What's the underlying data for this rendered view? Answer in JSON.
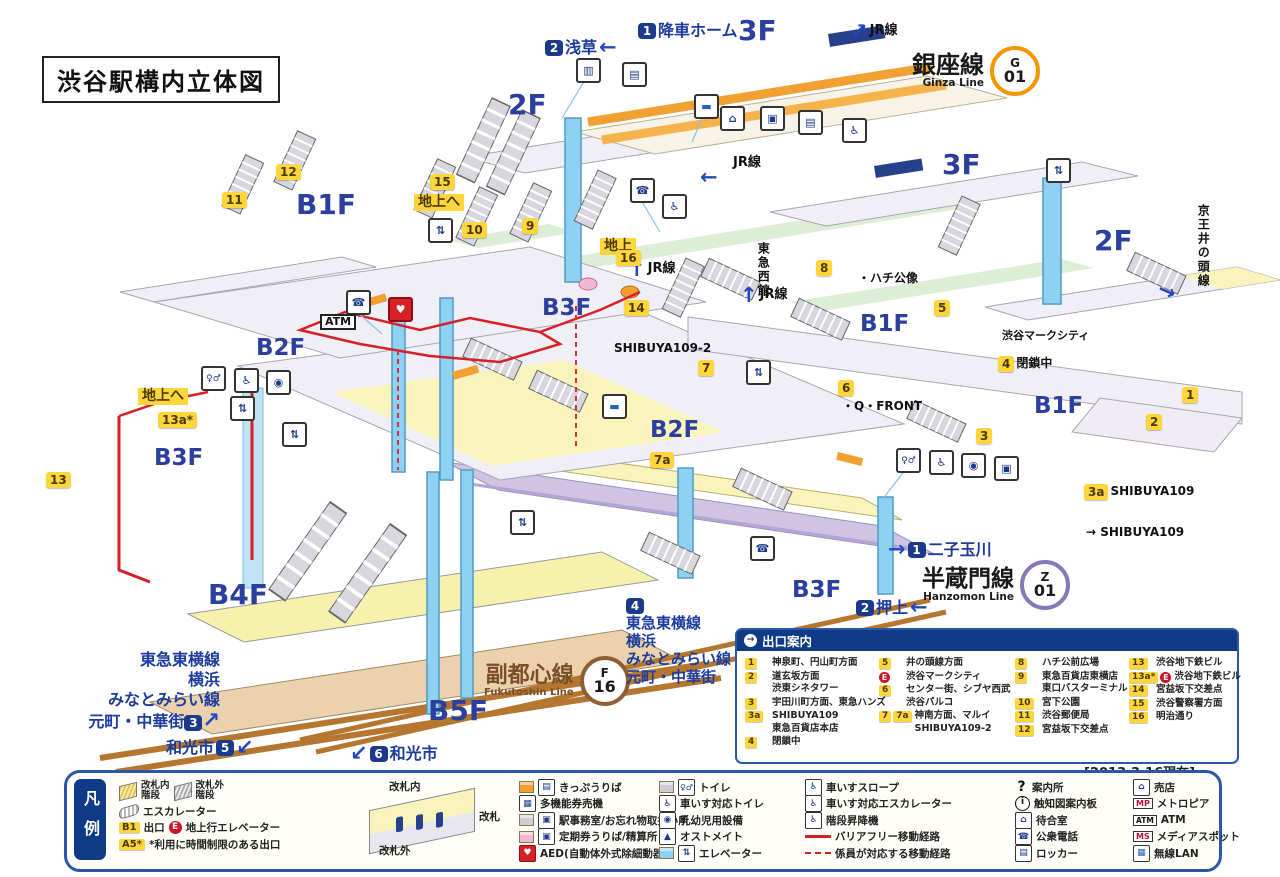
{
  "title": "渋谷駅構内立体図",
  "icons": {
    "header_arrow": "→",
    "shop": "⌂",
    "phone": "☎",
    "wheelchair": "♿",
    "toilet": "♀♂",
    "baby": "◉",
    "elevator": "⇅",
    "gates": "▥",
    "machine": "▤",
    "office": "▣",
    "bus": "▬",
    "aed": "♥",
    "locker": "▤",
    "waiting": "⌂",
    "lan": "▦",
    "info_q": "?",
    "info_i": "i",
    "mp": "MP",
    "atm": "ATM",
    "ms": "MS",
    "ostomate": "▲",
    "multi_machine": "▦"
  },
  "lines": {
    "ginza": {
      "name": "銀座線",
      "en": "Ginza Line",
      "letter": "G",
      "num": "01"
    },
    "hanzomon": {
      "name": "半蔵門線",
      "en": "Hanzomon Line",
      "letter": "Z",
      "num": "01"
    },
    "fukutoshin": {
      "name": "副都心線",
      "en": "Fukutoshin Line",
      "letter": "F",
      "num": "16"
    }
  },
  "groups": {
    "g3": {
      "l1": "東急東横線",
      "l2": "横浜",
      "l3": "みなとみらい線",
      "l4": "元町・中華街",
      "badge": "3",
      "arrow": "↗"
    },
    "g4": {
      "badge": "4",
      "l1": "東急東横線",
      "l2": "横浜",
      "l3": "みなとみらい線",
      "l4": "元町・中華街"
    }
  },
  "map": {
    "labels": [
      {
        "n": "floor-3f-top",
        "x": 738,
        "y": 16,
        "cls": "floor-lg",
        "p": [
          {
            "k": "floor",
            "t": "3F"
          }
        ]
      },
      {
        "n": "floor-2f-left",
        "x": 508,
        "y": 90,
        "cls": "floor-lg",
        "p": [
          {
            "k": "floor",
            "t": "2F"
          }
        ]
      },
      {
        "n": "floor-b1f-left",
        "x": 296,
        "y": 190,
        "cls": "floor-lg",
        "p": [
          {
            "k": "floor",
            "t": "B1F"
          }
        ]
      },
      {
        "n": "floor-3f-right",
        "x": 942,
        "y": 150,
        "cls": "floor-lg",
        "p": [
          {
            "k": "floor",
            "t": "3F"
          }
        ]
      },
      {
        "n": "floor-2f-right",
        "x": 1094,
        "y": 226,
        "cls": "floor-lg",
        "p": [
          {
            "k": "floor",
            "t": "2F"
          }
        ]
      },
      {
        "n": "floor-b1f-mid",
        "x": 860,
        "y": 312,
        "cls": "floor-md",
        "p": [
          {
            "k": "floor",
            "t": "B1F"
          }
        ]
      },
      {
        "n": "floor-b1f-right",
        "x": 1034,
        "y": 394,
        "cls": "floor-md",
        "p": [
          {
            "k": "floor",
            "t": "B1F"
          }
        ]
      },
      {
        "n": "floor-b2f-left",
        "x": 256,
        "y": 336,
        "cls": "floor-md",
        "p": [
          {
            "k": "floor",
            "t": "B2F"
          }
        ]
      },
      {
        "n": "floor-b3f-mid",
        "x": 542,
        "y": 296,
        "cls": "floor-md",
        "p": [
          {
            "k": "floor",
            "t": "B3F"
          }
        ]
      },
      {
        "n": "floor-b2f-mid",
        "x": 650,
        "y": 418,
        "cls": "floor-md",
        "p": [
          {
            "k": "floor",
            "t": "B2F"
          }
        ]
      },
      {
        "n": "floor-b3f-left",
        "x": 154,
        "y": 446,
        "cls": "floor-md",
        "p": [
          {
            "k": "floor",
            "t": "B3F"
          }
        ]
      },
      {
        "n": "floor-b3f-bottom",
        "x": 792,
        "y": 578,
        "cls": "floor-md",
        "p": [
          {
            "k": "floor",
            "t": "B3F"
          }
        ]
      },
      {
        "n": "floor-b4f",
        "x": 208,
        "y": 580,
        "cls": "floor-lg",
        "p": [
          {
            "k": "floor",
            "t": "B4F"
          }
        ]
      },
      {
        "n": "floor-b5f",
        "x": 428,
        "y": 696,
        "cls": "floor-lg",
        "p": [
          {
            "k": "floor",
            "t": "B5F"
          }
        ]
      },
      {
        "n": "deboarding-platform",
        "x": 638,
        "y": 22,
        "p": [
          {
            "k": "navy",
            "t": "1"
          },
          {
            "k": "plain",
            "t": "降車ホーム"
          }
        ]
      },
      {
        "n": "to-asakusa",
        "x": 545,
        "y": 36,
        "p": [
          {
            "k": "navy",
            "t": "2"
          },
          {
            "k": "plain",
            "t": "浅草"
          },
          {
            "k": "arrowbig",
            "t": "←"
          }
        ]
      },
      {
        "n": "jr-line-top",
        "x": 850,
        "y": 20,
        "p": [
          {
            "k": "arrowbig",
            "t": "↗"
          },
          {
            "k": "dark13",
            "t": "JR線"
          }
        ]
      },
      {
        "n": "jr-line-3f",
        "x": 733,
        "y": 156,
        "p": [
          {
            "k": "dark13",
            "t": "JR線"
          }
        ]
      },
      {
        "n": "jr-line-3f-arrow",
        "x": 700,
        "y": 166,
        "p": [
          {
            "k": "arrowbig",
            "t": "←"
          }
        ]
      },
      {
        "n": "jr-line-b1-west",
        "x": 628,
        "y": 258,
        "p": [
          {
            "k": "arrowbig",
            "t": "↑"
          },
          {
            "k": "dark13",
            "t": "JR線"
          }
        ]
      },
      {
        "n": "jr-line-b1-east",
        "x": 740,
        "y": 284,
        "p": [
          {
            "k": "arrowbig",
            "t": "↑"
          },
          {
            "k": "dark13",
            "t": "JR線"
          }
        ]
      },
      {
        "n": "tokyu-west-bldg",
        "x": 756,
        "y": 242,
        "cls": "vert",
        "p": [
          {
            "k": "dark12",
            "t": "東急西館"
          }
        ]
      },
      {
        "n": "keio-inokashira-line",
        "x": 1196,
        "y": 204,
        "cls": "vert",
        "p": [
          {
            "k": "dark12",
            "t": "京王井の頭線"
          }
        ]
      },
      {
        "n": "keio-arrow",
        "x": 1158,
        "y": 280,
        "cls": "rot20",
        "p": [
          {
            "k": "arrowbig",
            "t": "→"
          }
        ]
      },
      {
        "n": "to-futako-tamagawa",
        "x": 888,
        "y": 538,
        "p": [
          {
            "k": "arrowbig",
            "t": "→"
          },
          {
            "k": "navy",
            "t": "1"
          },
          {
            "k": "plain",
            "t": "二子玉川"
          }
        ]
      },
      {
        "n": "to-oshiage",
        "x": 856,
        "y": 596,
        "p": [
          {
            "k": "navy",
            "t": "2"
          },
          {
            "k": "plain",
            "t": "押上"
          },
          {
            "k": "arrowbig",
            "t": "←"
          }
        ]
      },
      {
        "n": "to-wakoshi-5",
        "x": 166,
        "y": 736,
        "p": [
          {
            "k": "plain",
            "t": "和光市"
          },
          {
            "k": "navy",
            "t": "5"
          },
          {
            "k": "arrowbig",
            "t": "↙"
          }
        ]
      },
      {
        "n": "to-wakoshi-6",
        "x": 350,
        "y": 742,
        "p": [
          {
            "k": "arrowbig",
            "t": "↙"
          },
          {
            "k": "navy",
            "t": "6"
          },
          {
            "k": "plain",
            "t": "和光市"
          }
        ]
      },
      {
        "n": "hachiko-statue",
        "x": 858,
        "y": 272,
        "p": [
          {
            "k": "dark12",
            "t": "・ハチ公像"
          }
        ]
      },
      {
        "n": "shibuya-mark-city",
        "x": 1002,
        "y": 330,
        "p": [
          {
            "k": "dark11",
            "t": "渋谷マークシティ"
          }
        ]
      },
      {
        "n": "q-front",
        "x": 842,
        "y": 400,
        "p": [
          {
            "k": "dark12",
            "t": "・Q・FRONT"
          }
        ]
      },
      {
        "n": "shibuya109-2",
        "x": 614,
        "y": 342,
        "p": [
          {
            "k": "dark12",
            "t": "SHIBUYA109-2"
          }
        ]
      },
      {
        "n": "to-shibuya109",
        "x": 1086,
        "y": 526,
        "p": [
          {
            "k": "dark12",
            "t": "→ SHIBUYA109"
          }
        ]
      },
      {
        "n": "exit-3a-shibuya109",
        "x": 1084,
        "y": 484,
        "p": [
          {
            "k": "yb",
            "t": "3a"
          },
          {
            "k": "dark12",
            "t": "SHIBUYA109"
          }
        ]
      },
      {
        "n": "exit-4-closed",
        "x": 998,
        "y": 356,
        "p": [
          {
            "k": "yb",
            "t": "4"
          },
          {
            "k": "dark12",
            "t": "閉鎖中"
          }
        ]
      },
      {
        "n": "exit-15",
        "x": 430,
        "y": 174,
        "p": [
          {
            "k": "yb",
            "t": "15"
          }
        ]
      },
      {
        "n": "to-ground-15",
        "x": 414,
        "y": 194,
        "p": [
          {
            "k": "hl",
            "t": "地上へ"
          }
        ]
      },
      {
        "n": "ground-center",
        "x": 600,
        "y": 238,
        "p": [
          {
            "k": "hl",
            "t": "地上"
          }
        ]
      },
      {
        "n": "to-ground-13a",
        "x": 138,
        "y": 388,
        "p": [
          {
            "k": "hl",
            "t": "地上へ"
          }
        ]
      },
      {
        "n": "exit-13a",
        "x": 158,
        "y": 412,
        "p": [
          {
            "k": "yb",
            "t": "13a*"
          }
        ]
      },
      {
        "n": "exit-11",
        "x": 222,
        "y": 192,
        "p": [
          {
            "k": "yb",
            "t": "11"
          }
        ]
      },
      {
        "n": "exit-12",
        "x": 276,
        "y": 164,
        "p": [
          {
            "k": "yb",
            "t": "12"
          }
        ]
      },
      {
        "n": "exit-10",
        "x": 462,
        "y": 222,
        "p": [
          {
            "k": "yb",
            "t": "10"
          }
        ]
      },
      {
        "n": "exit-9",
        "x": 522,
        "y": 218,
        "p": [
          {
            "k": "yb",
            "t": "9"
          }
        ]
      },
      {
        "n": "exit-16",
        "x": 616,
        "y": 250,
        "p": [
          {
            "k": "yb",
            "t": "16"
          }
        ]
      },
      {
        "n": "exit-14",
        "x": 624,
        "y": 300,
        "p": [
          {
            "k": "yb",
            "t": "14"
          }
        ]
      },
      {
        "n": "exit-8",
        "x": 816,
        "y": 260,
        "p": [
          {
            "k": "yb",
            "t": "8"
          }
        ]
      },
      {
        "n": "exit-5",
        "x": 934,
        "y": 300,
        "p": [
          {
            "k": "yb",
            "t": "5"
          }
        ]
      },
      {
        "n": "exit-7",
        "x": 698,
        "y": 360,
        "p": [
          {
            "k": "yb",
            "t": "7"
          }
        ]
      },
      {
        "n": "exit-6",
        "x": 838,
        "y": 380,
        "p": [
          {
            "k": "yb",
            "t": "6"
          }
        ]
      },
      {
        "n": "exit-7a",
        "x": 650,
        "y": 452,
        "p": [
          {
            "k": "yb",
            "t": "7a"
          }
        ]
      },
      {
        "n": "exit-3",
        "x": 976,
        "y": 428,
        "p": [
          {
            "k": "yb",
            "t": "3"
          }
        ]
      },
      {
        "n": "exit-2",
        "x": 1146,
        "y": 414,
        "p": [
          {
            "k": "yb",
            "t": "2"
          }
        ]
      },
      {
        "n": "exit-1",
        "x": 1182,
        "y": 387,
        "p": [
          {
            "k": "yb",
            "t": "1"
          }
        ]
      },
      {
        "n": "exit-13",
        "x": 46,
        "y": 472,
        "p": [
          {
            "k": "yb",
            "t": "13"
          }
        ]
      },
      {
        "n": "atm-label",
        "x": 320,
        "y": 314,
        "p": [
          {
            "k": "atm",
            "t": "ATM"
          }
        ]
      }
    ],
    "minis": [
      {
        "n": "ticket-gate-icon",
        "x": 576,
        "y": 58,
        "g": "▥"
      },
      {
        "n": "fare-machine-icon",
        "x": 622,
        "y": 62,
        "g": "▤"
      },
      {
        "n": "bus-icon",
        "x": 694,
        "y": 94,
        "g": "▬",
        "c": "blue"
      },
      {
        "n": "shop-icon",
        "x": 720,
        "y": 106,
        "g": "⌂"
      },
      {
        "n": "office-icon",
        "x": 760,
        "y": 106,
        "g": "▣"
      },
      {
        "n": "fare-machine-icon",
        "x": 798,
        "y": 110,
        "g": "▤"
      },
      {
        "n": "wheelchair-escalator-icon",
        "x": 842,
        "y": 118,
        "g": "♿"
      },
      {
        "n": "phone-icon",
        "x": 630,
        "y": 178,
        "g": "☎"
      },
      {
        "n": "wheelchair-icon",
        "x": 662,
        "y": 194,
        "g": "♿"
      },
      {
        "n": "elevator-icon",
        "x": 428,
        "y": 218,
        "g": "⇅"
      },
      {
        "n": "elevator-icon",
        "x": 1046,
        "y": 158,
        "g": "⇅"
      },
      {
        "n": "phone-icon",
        "x": 346,
        "y": 290,
        "g": "☎"
      },
      {
        "n": "aed-icon",
        "x": 388,
        "y": 297,
        "g": "♥",
        "c": "red"
      },
      {
        "n": "toilet-icon",
        "x": 201,
        "y": 366,
        "g": "♀♂",
        "c": "sm"
      },
      {
        "n": "wheelchair-toilet-icon",
        "x": 234,
        "y": 368,
        "g": "♿"
      },
      {
        "n": "baby-facility-icon",
        "x": 266,
        "y": 370,
        "g": "◉"
      },
      {
        "n": "elevator-icon",
        "x": 230,
        "y": 396,
        "g": "⇅"
      },
      {
        "n": "elevator-icon",
        "x": 282,
        "y": 422,
        "g": "⇅"
      },
      {
        "n": "bus-icon",
        "x": 602,
        "y": 394,
        "g": "▬",
        "c": "blue"
      },
      {
        "n": "elevator-icon",
        "x": 746,
        "y": 360,
        "g": "⇅"
      },
      {
        "n": "toilet-icon",
        "x": 896,
        "y": 448,
        "g": "♀♂",
        "c": "sm"
      },
      {
        "n": "wheelchair-toilet-icon",
        "x": 929,
        "y": 450,
        "g": "♿"
      },
      {
        "n": "baby-facility-icon",
        "x": 961,
        "y": 453,
        "g": "◉"
      },
      {
        "n": "office-icon",
        "x": 994,
        "y": 456,
        "g": "▣"
      },
      {
        "n": "phone-icon",
        "x": 750,
        "y": 536,
        "g": "☎"
      },
      {
        "n": "elevator-icon",
        "x": 510,
        "y": 510,
        "g": "⇅"
      }
    ]
  },
  "exit_guide": {
    "title": "出口案内",
    "date": "[2013.3.16現在]",
    "col1": [
      {
        "b0": "1",
        "l0": "神泉町、円山町方面"
      },
      {
        "b0": "2",
        "l0": "道玄坂方面",
        "l1": "渋東シネタワー"
      },
      {
        "b0": "3",
        "l0": "宇田川町方面、東急ハンズ"
      },
      {
        "b0": "3a",
        "l0": "SHIBUYA109",
        "l1": "東急百貨店本店"
      },
      {
        "b0": "4",
        "l0": "閉鎖中"
      }
    ],
    "col2": [
      {
        "b0": "5",
        "l0": "井の頭線方面"
      },
      {
        "e": "E",
        "l0": "渋谷マークシティ"
      },
      {
        "b0": "6",
        "l0": "センター街、シブヤ西武",
        "l1": "渋谷パルコ"
      },
      {
        "b0": "7",
        "b1": "7a",
        "l0": "神南方面、マルイ",
        "l1": "SHIBUYA109-2"
      }
    ],
    "col3": [
      {
        "b0": "8",
        "l0": "ハチ公前広場"
      },
      {
        "b0": "9",
        "l0": "東急百貨店東横店",
        "l1": "東口バスターミナル"
      },
      {
        "b0": "10",
        "l0": "宮下公園"
      },
      {
        "b0": "11",
        "l0": "渋谷郵便局"
      },
      {
        "b0": "12",
        "l0": "宮益坂下交差点"
      }
    ],
    "col4": [
      {
        "b0": "13",
        "l0": "渋谷地下鉄ビル"
      },
      {
        "b0": "13a*",
        "e": "E",
        "l0": "渋谷地下鉄ビル"
      },
      {
        "b0": "14",
        "l0": "宮益坂下交差点"
      },
      {
        "b0": "15",
        "l0": "渋谷警察署方面"
      },
      {
        "b0": "16",
        "l0": "明治通り"
      }
    ]
  },
  "legend": {
    "tab": "凡例",
    "a1a": "改札内",
    "a1b": "階段",
    "a2a": "改札外",
    "a2b": "階段",
    "a3": "エスカレーター",
    "b1_badge": "B1",
    "a4": "出口",
    "e_badge": "E",
    "a5": "地上行エレベーター",
    "a5_badge": "A5*",
    "a6": "*利用に時間制限のある出口",
    "gate_top": "改札内",
    "gate_mid": "改札",
    "gate_bottom": "改札外",
    "c": [
      "きっぷうりば",
      "多機能券売機",
      "駅事務室/お忘れ物取扱い所",
      "定期券うりば/精算所",
      "AED(自動体外式除細動器)"
    ],
    "d": [
      "トイレ",
      "車いす対応トイレ",
      "乳幼児用設備",
      "オストメイト",
      "エレベーター"
    ],
    "e": [
      "車いすスロープ",
      "車いす対応エスカレーター",
      "階段昇降機",
      "バリアフリー移動経路",
      "係員が対応する移動経路"
    ],
    "f": [
      "案内所",
      "触知図案内板",
      "待合室",
      "公衆電話",
      "ロッカー"
    ],
    "g": [
      "売店",
      "メトロピア",
      "ATM",
      "メディアスポット",
      "無線LAN"
    ]
  }
}
